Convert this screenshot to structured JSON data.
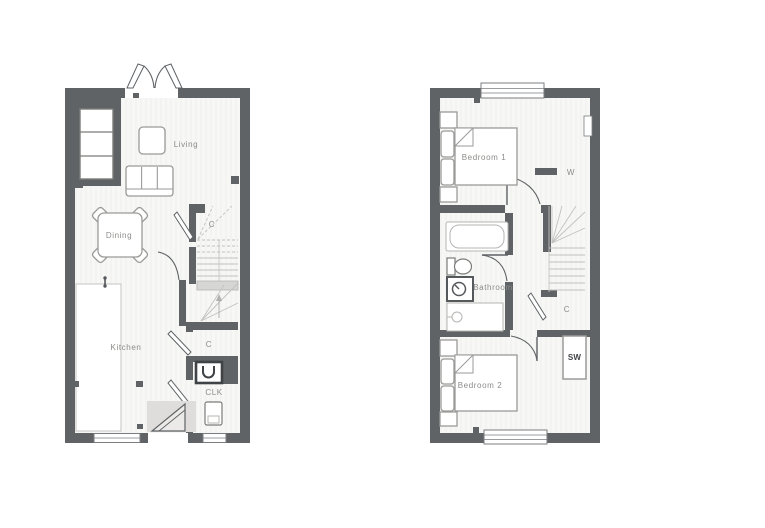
{
  "title": "Two storey house floor plan",
  "palette": {
    "wall": "#5f6366",
    "floor": "#f7f7f5",
    "floor_stripe": "#ececea",
    "furniture_line": "#9a9a98",
    "faint_line": "#c2c2c0",
    "label_text": "#8b8b89",
    "dark_text": "#3f4346",
    "entrance_shade": "#dedddb"
  },
  "ground_floor": {
    "labels": {
      "living": "Living",
      "dining": "Dining",
      "kitchen": "Kitchen",
      "stairs_cupboard": "C",
      "hall_cupboard": "C",
      "cloakroom": "CLK"
    }
  },
  "first_floor": {
    "labels": {
      "bedroom1": "Bedroom 1",
      "wardrobe": "W",
      "bathroom": "Bathroom",
      "landing_cupboard": "C",
      "store_wardrobe": "SW",
      "bedroom2": "Bedroom 2"
    }
  }
}
